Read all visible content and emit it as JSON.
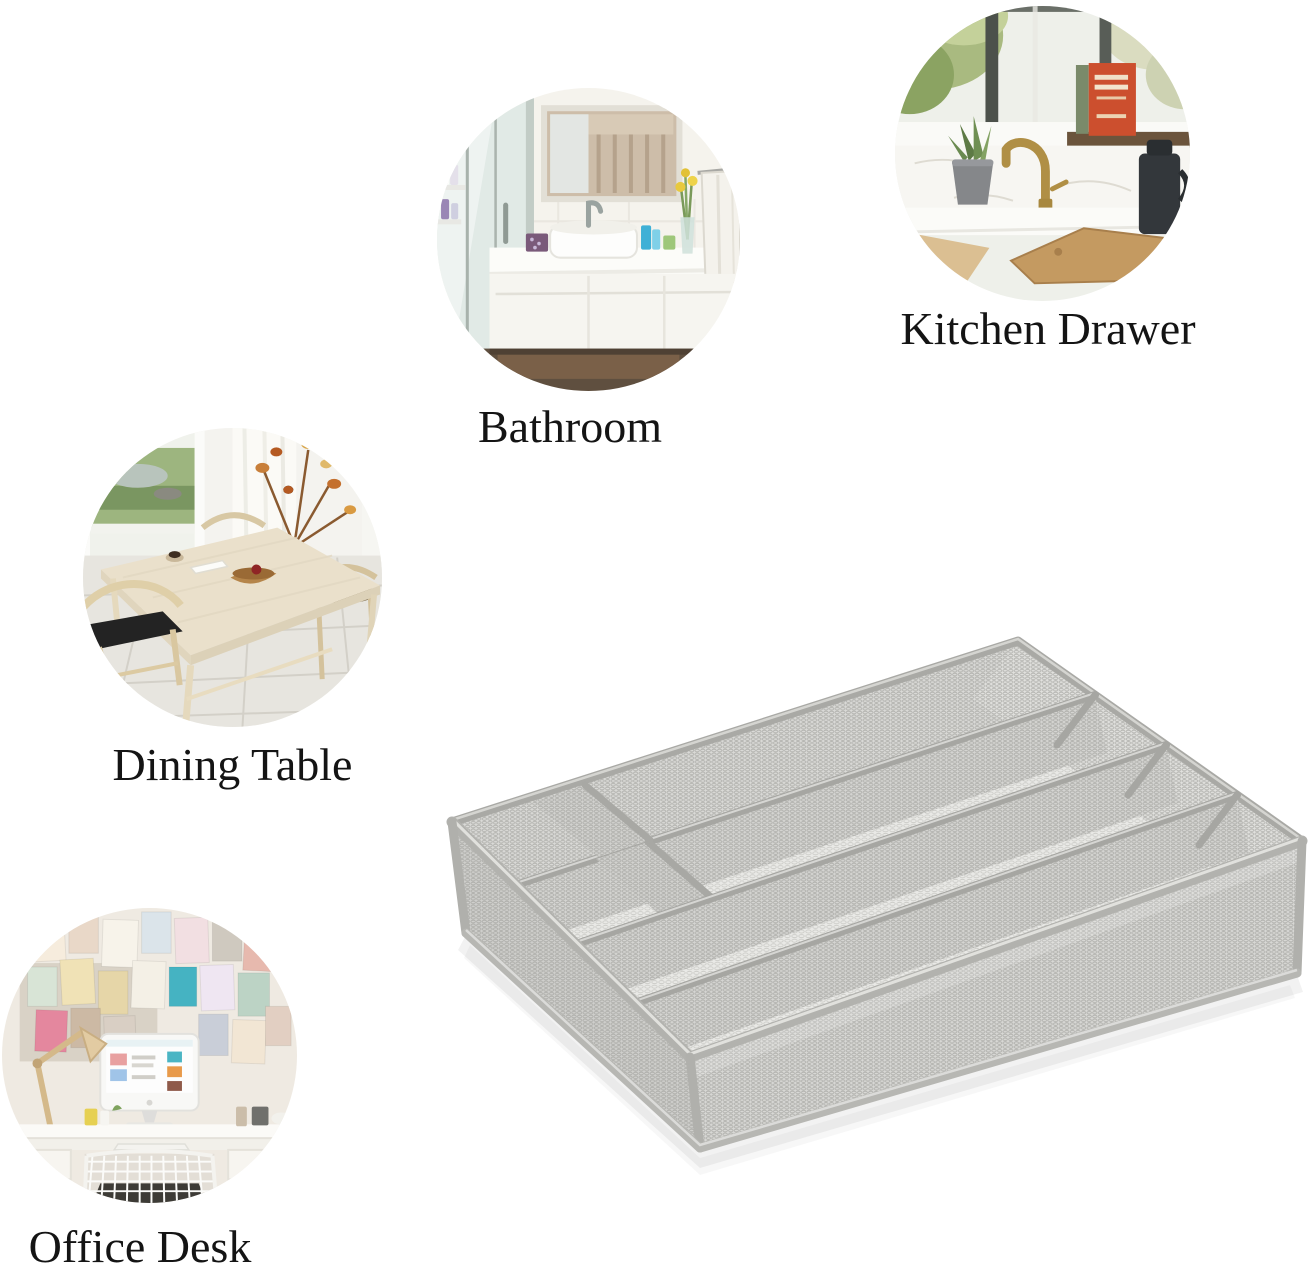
{
  "page": {
    "background_color": "#ffffff"
  },
  "use_cases": [
    {
      "id": "kitchen-drawer",
      "label": "Kitchen Drawer"
    },
    {
      "id": "bathroom",
      "label": "Bathroom"
    },
    {
      "id": "dining-table",
      "label": "Dining Table"
    },
    {
      "id": "office-desk",
      "label": "Office Desk"
    }
  ],
  "product": {
    "icon": "mesh-cutlery-tray",
    "frame_color": "#a9a9a5",
    "mesh_color": "#d8d8d5"
  },
  "label_color": "#141414"
}
